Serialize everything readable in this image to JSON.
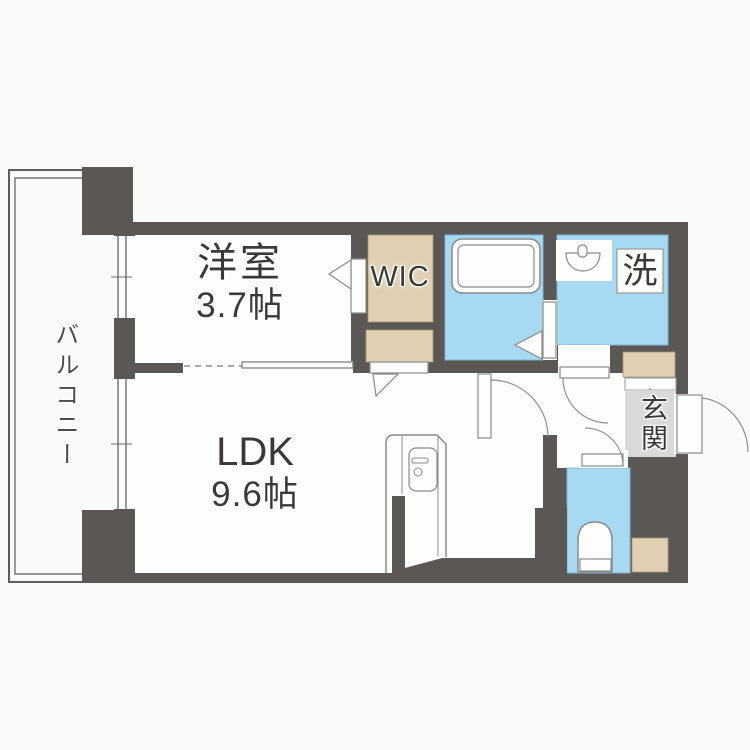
{
  "floorplan": {
    "balcony": {
      "label": "バルコニー"
    },
    "bedroom": {
      "name": "洋室",
      "size": "3.7帖"
    },
    "ldk": {
      "name": "LDK",
      "size": "9.6帖"
    },
    "wic": {
      "label": "WIC"
    },
    "laundry": {
      "label": "洗"
    },
    "entrance": {
      "label": "玄関"
    },
    "colors": {
      "wall": "#5b5755",
      "wet_area": "#a8d9f2",
      "storage": "#e0cfb2",
      "entrance_floor": "#d9d9d8",
      "room_floor": "#fdfdfb",
      "background": "#fafaf8"
    },
    "icons": {
      "bathtub": "bathtub-icon",
      "washbasin": "washbasin-icon",
      "toilet": "toilet-icon",
      "kitchen": "kitchen-unit-icon"
    }
  }
}
